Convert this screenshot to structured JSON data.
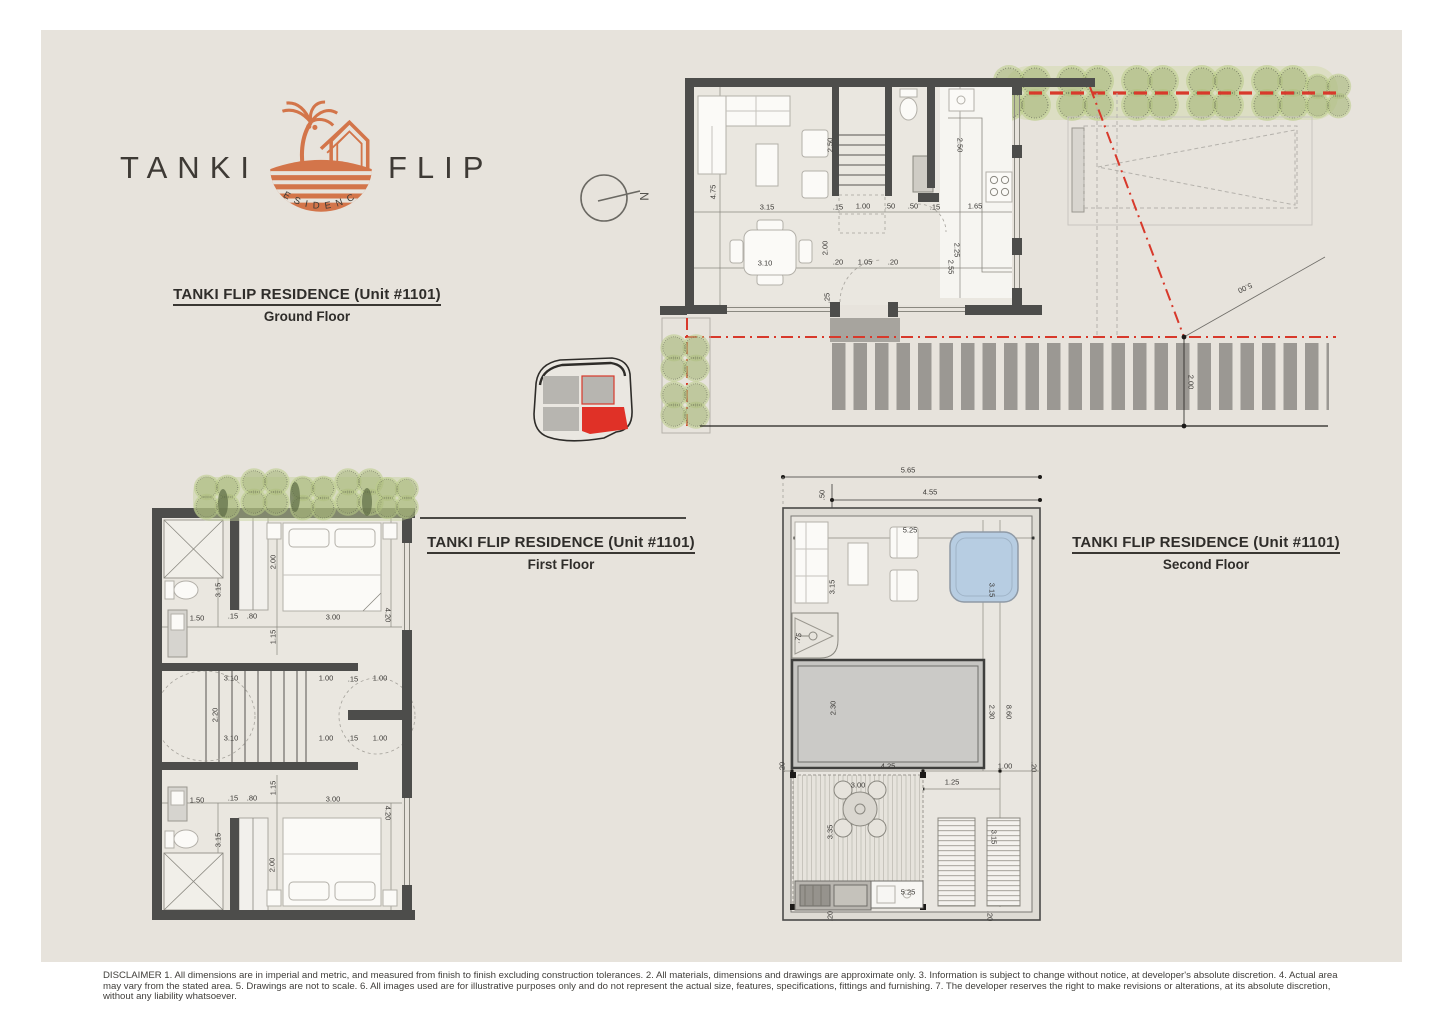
{
  "logo": {
    "word_left": "TANKI",
    "word_right": "FLIP",
    "emblem_text": "RESIDENCE"
  },
  "compass": {
    "label": "N"
  },
  "titles": {
    "ground": {
      "line1": "TANKI FLIP RESIDENCE (Unit #1101)",
      "line2": "Ground Floor"
    },
    "first": {
      "line1": "TANKI FLIP RESIDENCE (Unit #1101)",
      "line2": "First Floor"
    },
    "second": {
      "line1": "TANKI FLIP RESIDENCE (Unit #1101)",
      "line2": "Second Floor"
    }
  },
  "colors": {
    "accent_orange": "#d3754a",
    "site_red": "#d8392b",
    "tree_green": "#b9cc86",
    "jacuzzi_blue": "#b7cde2",
    "wall_gray": "#4d4d4b",
    "board_beige": "#e7e3dc"
  },
  "plans": {
    "ground_site": {
      "dims": [
        {
          "t": "4.75",
          "x": 53,
          "y": 132,
          "r": -90
        },
        {
          "t": "3.15",
          "x": 107,
          "y": 147
        },
        {
          "t": "2.50",
          "x": 170,
          "y": 85,
          "r": -90
        },
        {
          "t": ".15",
          "x": 178,
          "y": 147
        },
        {
          "t": "1.00",
          "x": 203,
          "y": 146
        },
        {
          "t": ".50",
          "x": 230,
          "y": 146
        },
        {
          "t": ".50",
          "x": 253,
          "y": 146
        },
        {
          "t": ".15",
          "x": 275,
          "y": 147
        },
        {
          "t": "1.65",
          "x": 315,
          "y": 146
        },
        {
          "t": "2.50",
          "x": 300,
          "y": 85,
          "r": 90
        },
        {
          "t": "2.00",
          "x": 165,
          "y": 188,
          "r": -90
        },
        {
          "t": "2.25",
          "x": 297,
          "y": 190,
          "r": 90
        },
        {
          "t": "2.55",
          "x": 291,
          "y": 207,
          "r": 90
        },
        {
          "t": "3.10",
          "x": 105,
          "y": 203
        },
        {
          "t": ".20",
          "x": 178,
          "y": 202
        },
        {
          "t": "1.05",
          "x": 205,
          "y": 202
        },
        {
          "t": ".20",
          "x": 233,
          "y": 202
        },
        {
          "t": ".25",
          "x": 167,
          "y": 238,
          "r": -90
        },
        {
          "t": "5.00",
          "x": 585,
          "y": 228,
          "r": 155
        },
        {
          "t": "2.00",
          "x": 531,
          "y": 322,
          "r": 90
        }
      ]
    },
    "first": {
      "dims": [
        {
          "t": "3.15",
          "x": 73,
          "y": 115,
          "r": -90
        },
        {
          "t": "2.00",
          "x": 128,
          "y": 87,
          "r": -90
        },
        {
          "t": "1.50",
          "x": 52,
          "y": 143
        },
        {
          "t": ".15",
          "x": 88,
          "y": 141
        },
        {
          "t": ".80",
          "x": 107,
          "y": 141
        },
        {
          "t": "3.00",
          "x": 188,
          "y": 142
        },
        {
          "t": "4.20",
          "x": 243,
          "y": 140,
          "r": 90
        },
        {
          "t": "1.15",
          "x": 128,
          "y": 162,
          "r": -90
        },
        {
          "t": "3.10",
          "x": 86,
          "y": 203
        },
        {
          "t": "1.00",
          "x": 181,
          "y": 203
        },
        {
          "t": ".15",
          "x": 208,
          "y": 204
        },
        {
          "t": "1.00",
          "x": 235,
          "y": 203
        },
        {
          "t": "2.20",
          "x": 70,
          "y": 240,
          "r": -90
        },
        {
          "t": "3.10",
          "x": 86,
          "y": 263
        },
        {
          "t": "1.00",
          "x": 181,
          "y": 263
        },
        {
          "t": ".15",
          "x": 208,
          "y": 263
        },
        {
          "t": "1.00",
          "x": 235,
          "y": 263
        },
        {
          "t": "1.50",
          "x": 52,
          "y": 325
        },
        {
          "t": ".15",
          "x": 88,
          "y": 323
        },
        {
          "t": ".80",
          "x": 107,
          "y": 323
        },
        {
          "t": "1.15",
          "x": 128,
          "y": 313,
          "r": -90
        },
        {
          "t": "3.00",
          "x": 188,
          "y": 324
        },
        {
          "t": "4.20",
          "x": 243,
          "y": 338,
          "r": 90
        },
        {
          "t": "3.15",
          "x": 73,
          "y": 365,
          "r": -90
        },
        {
          "t": "2.00",
          "x": 127,
          "y": 390,
          "r": -90
        }
      ]
    },
    "second": {
      "dims": [
        {
          "t": "5.65",
          "x": 133,
          "y": 10
        },
        {
          "t": ".50",
          "x": 47,
          "y": 35,
          "r": -90
        },
        {
          "t": "4.55",
          "x": 155,
          "y": 32
        },
        {
          "t": "5.25",
          "x": 135,
          "y": 70
        },
        {
          "t": "3.15",
          "x": 57,
          "y": 127,
          "r": -90
        },
        {
          "t": "3.15",
          "x": 217,
          "y": 130,
          "r": 90
        },
        {
          "t": ".75",
          "x": 23,
          "y": 178,
          "r": -75
        },
        {
          "t": "2.30",
          "x": 58,
          "y": 248,
          "r": -90
        },
        {
          "t": "2.30",
          "x": 217,
          "y": 252,
          "r": 90
        },
        {
          "t": "8.60",
          "x": 234,
          "y": 252,
          "r": 90
        },
        {
          "t": ".20",
          "x": 7,
          "y": 307,
          "r": -90
        },
        {
          "t": "4.25",
          "x": 113,
          "y": 306
        },
        {
          "t": "1.00",
          "x": 230,
          "y": 306
        },
        {
          "t": ".20",
          "x": 259,
          "y": 307,
          "r": 90
        },
        {
          "t": "3.00",
          "x": 83,
          "y": 325
        },
        {
          "t": "1.25",
          "x": 177,
          "y": 322
        },
        {
          "t": "3.35",
          "x": 55,
          "y": 372,
          "r": -90
        },
        {
          "t": "3.15",
          "x": 219,
          "y": 377,
          "r": 90
        },
        {
          "t": "5.25",
          "x": 133,
          "y": 432
        },
        {
          "t": ".20",
          "x": 55,
          "y": 456,
          "r": -90
        },
        {
          "t": ".20",
          "x": 215,
          "y": 456,
          "r": 90
        }
      ]
    }
  },
  "disclaimer": "DISCLAIMER 1. All dimensions are in imperial and metric, and measured from finish to finish excluding construction tolerances. 2. All materials, dimensions and drawings are approximate only. 3. Information is subject to change without notice, at developer's absolute discretion. 4. Actual area may vary from the stated area. 5. Drawings are not to scale. 6. All images used are for illustrative purposes only and do not represent the actual size, features, specifications, fittings and furnishing. 7. The developer reserves the right to make revisions or alterations, at its absolute discretion, without any liability whatsoever."
}
